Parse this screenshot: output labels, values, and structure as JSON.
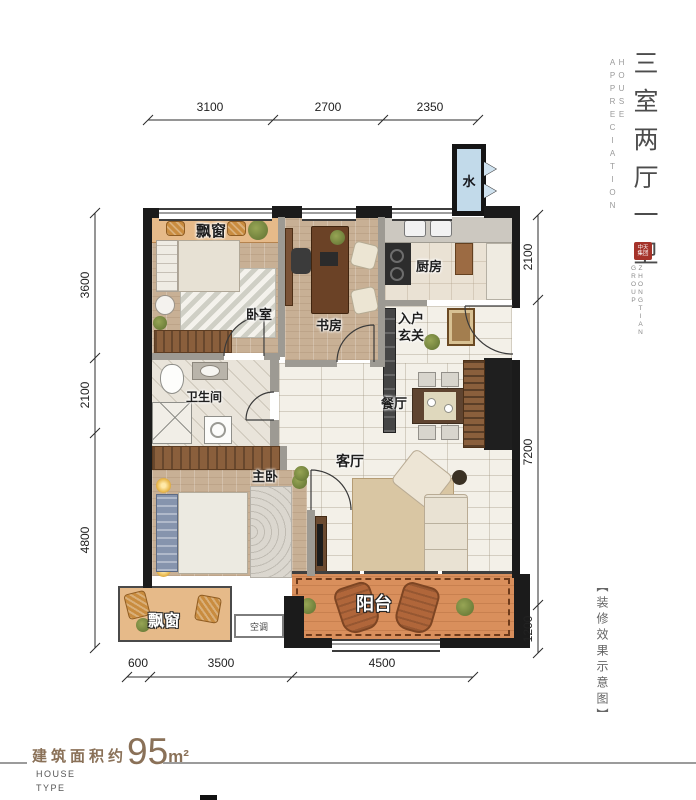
{
  "sidebar": {
    "title": "三室两厅一卫",
    "subtitle": "HOUSE APPRECIATION",
    "seal": "中天集团",
    "group": "ZHONGTIAN GROUP",
    "note": "【装修效果示意图】"
  },
  "footer": {
    "area_prefix": "建筑面积约",
    "area_value": "95",
    "area_unit": "m²",
    "type_line1": "HOUSE",
    "type_line2": "TYPE"
  },
  "plan": {
    "rooms": {
      "bay_top": "飘窗",
      "bedroom": "卧室",
      "study": "书房",
      "kitchen": "厨房",
      "entry_line1": "入户",
      "entry_line2": "玄关",
      "bathroom": "卫生间",
      "dining": "餐厅",
      "living": "客厅",
      "master": "主卧",
      "bay_bottom": "飘窗",
      "ac": "空调",
      "balcony": "阳台",
      "water": "水"
    },
    "dimensions": {
      "top": [
        "3100",
        "2700",
        "2350"
      ],
      "left": [
        "3600",
        "2100",
        "4800"
      ],
      "right": [
        "2100",
        "7200",
        "1200"
      ],
      "bottom": [
        "600",
        "3500",
        "4500"
      ]
    }
  },
  "colors": {
    "accent_brown": "#8a7158",
    "wall_black": "#1b1b1b",
    "balcony_orange": "#d98f5c",
    "bay_tan": "#e6ba89",
    "water_blue": "#c2daea",
    "seal_red": "#a5332a"
  }
}
